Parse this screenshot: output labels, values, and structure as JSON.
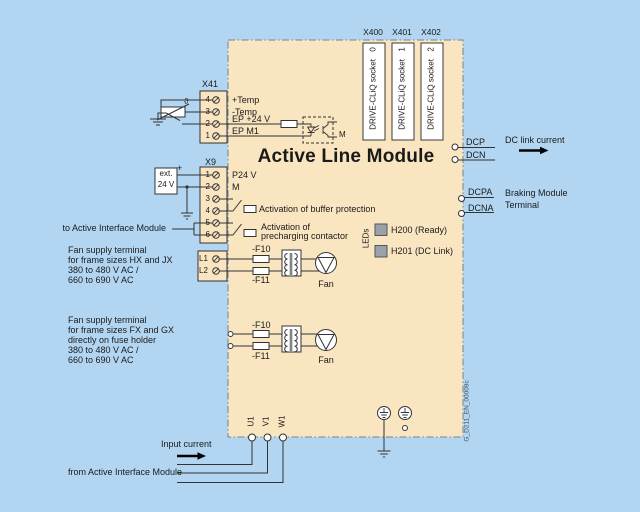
{
  "title": "Active Line Module",
  "watermark": "G_D211_EN_00009c",
  "colors": {
    "background": "#b2d6f2",
    "module_fill": "#fae5c1",
    "socket_fill": "#ffffff",
    "led_fill": "#9aa1a9",
    "wire": "#333333"
  },
  "x41": {
    "header": "X41",
    "pins": [
      "4",
      "3",
      "2",
      "1"
    ],
    "rows": [
      "+Temp",
      "-Temp",
      "EP +24 V",
      "EP M1"
    ],
    "theta": "ϑ",
    "m": "M"
  },
  "x9": {
    "header": "X9",
    "pins": [
      "1",
      "2",
      "3",
      "4",
      "5",
      "6"
    ],
    "p24": "P24 V",
    "m": "M",
    "ext1": "ext.",
    "ext2": "24 V",
    "plus": "+",
    "act_buffer": "Activation of buffer protection",
    "act_pre1": "Activation of",
    "act_pre2": "precharging contactor"
  },
  "cliq": {
    "headers": [
      "X400",
      "X401",
      "X402"
    ],
    "numbers": [
      "0",
      "1",
      "2"
    ],
    "socket": "DRIVE-CLiQ socket"
  },
  "dc": {
    "dcp": "DCP",
    "dcn": "DCN",
    "link": "DC link current",
    "dcpa": "DCPA",
    "dcna": "DCNA",
    "brake1": "Braking Module",
    "brake2": "Terminal"
  },
  "leds": {
    "rot": "LEDs",
    "h200": "H200 (Ready)",
    "h201": "H201 (DC Link)"
  },
  "fan1": {
    "l1": "L1",
    "l2": "L2",
    "f10": "-F10",
    "f11": "-F11",
    "fan": "Fan"
  },
  "fan2": {
    "f10": "-F10",
    "f11": "-F11",
    "fan": "Fan"
  },
  "left": {
    "to_aim": "to Active Interface Module",
    "block1": [
      "Fan supply terminal",
      "for frame sizes HX and JX",
      "380 to 480 V AC /",
      "660 to 690 V AC"
    ],
    "block2": [
      "Fan supply terminal",
      "for frame sizes FX and GX",
      "directly on fuse holder",
      "380 to 480 V AC /",
      "660 to 690 V AC"
    ]
  },
  "bottom": {
    "u1": "U1",
    "v1": "V1",
    "w1": "W1",
    "input": "Input current",
    "from_aim": "from Active Interface Module"
  }
}
